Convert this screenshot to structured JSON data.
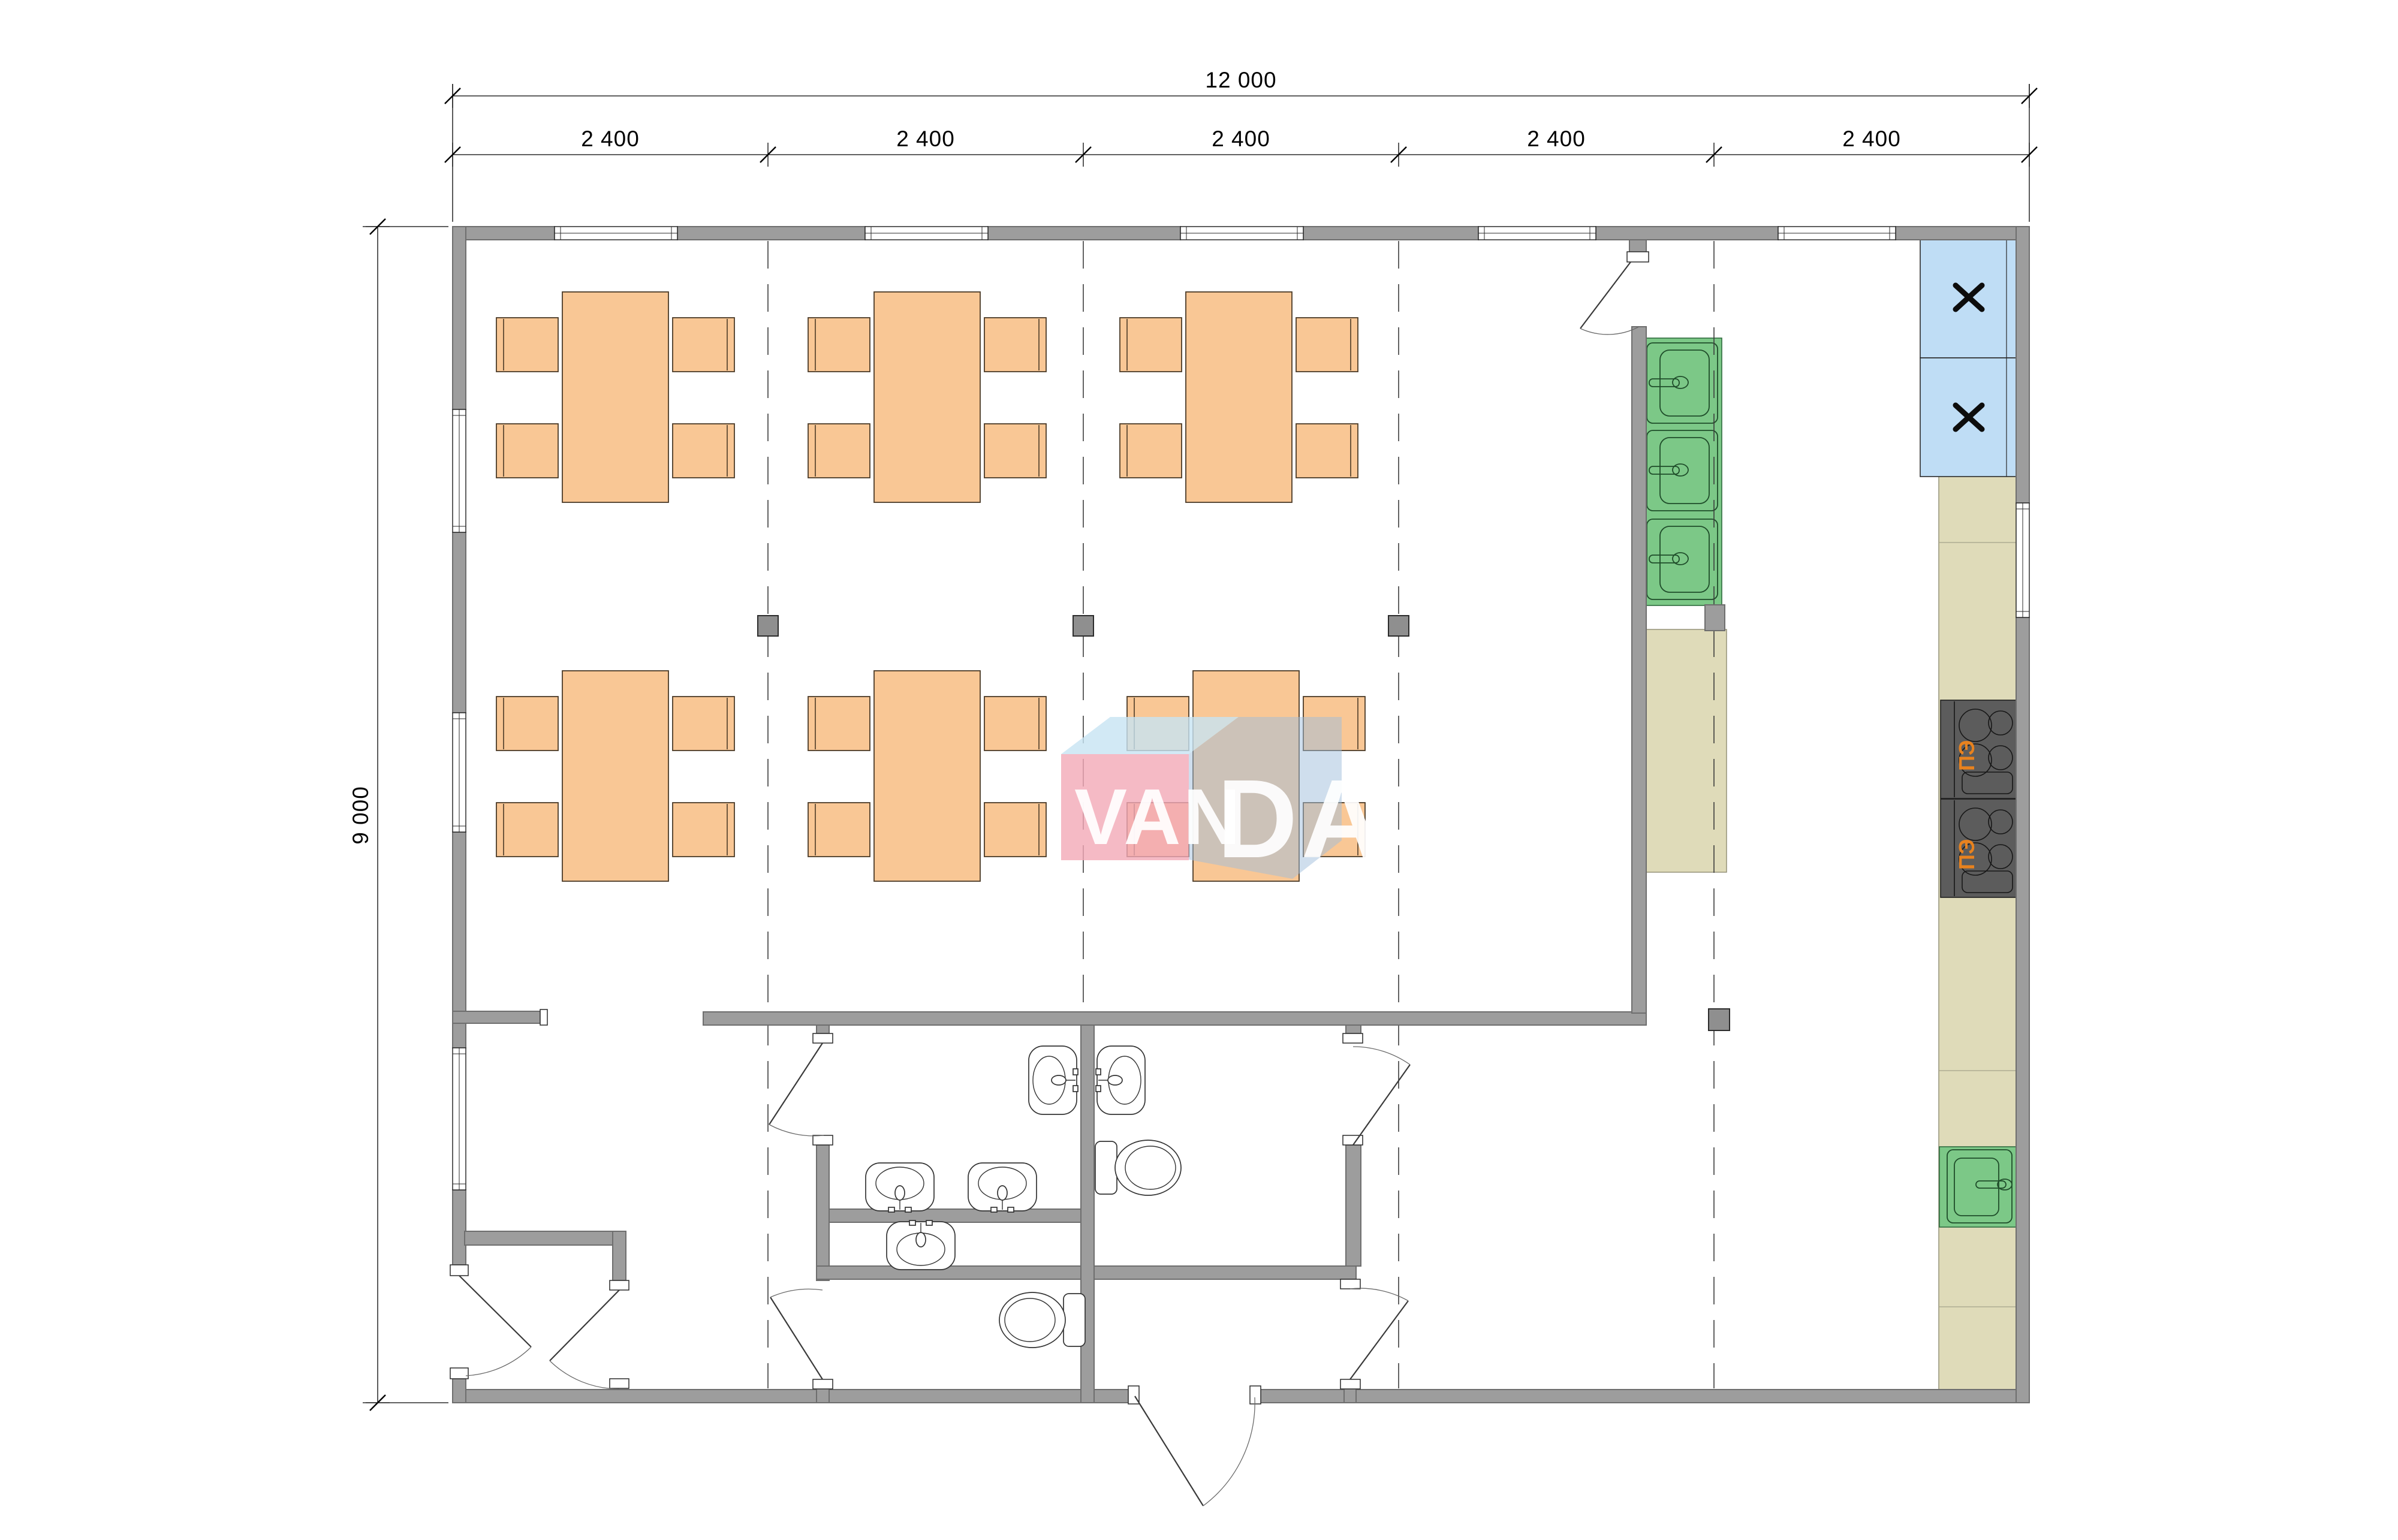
{
  "document": {
    "type": "architectural-floor-plan",
    "description": "Rectangular building plan 12000 x 9000 mm with dining tables, kitchen equipment and sanitary rooms, VANDA watermark"
  },
  "dimensions": {
    "total_width": "12 000",
    "height": "9 000",
    "modules": [
      "2 400",
      "2 400",
      "2 400",
      "2 400",
      "2 400"
    ]
  },
  "watermark": {
    "part1": "VAN",
    "part2": "DA"
  },
  "equipment": {
    "stove_label": "ПЭ",
    "stove_count": 2,
    "cabinet_mark_icon": "x-cross",
    "cabinet_count": 2,
    "kitchen_sink_count": 3,
    "single_sink_count": 2,
    "washroom_sink_count": 5,
    "toilet_count": 2,
    "dining_tables": 6,
    "chairs_per_table": 4
  },
  "colors": {
    "wall": "#9d9d9d",
    "wall-stroke": "#6e6e6e",
    "post": "#8f8f8f",
    "furniture": "#F9C795",
    "furniture-stroke": "#4b3a27",
    "cabinet-blue": "#BFDDF5",
    "counter-tan": "#DFDBB9",
    "appliance-green": "#7CC887",
    "stove-dark": "#5c5c5c",
    "stove-label": "#E8821E",
    "watermark-pink": "#F3A9B6",
    "watermark-topblue": "#C7E3F2",
    "watermark-sideblue": "#9FBEDC"
  }
}
